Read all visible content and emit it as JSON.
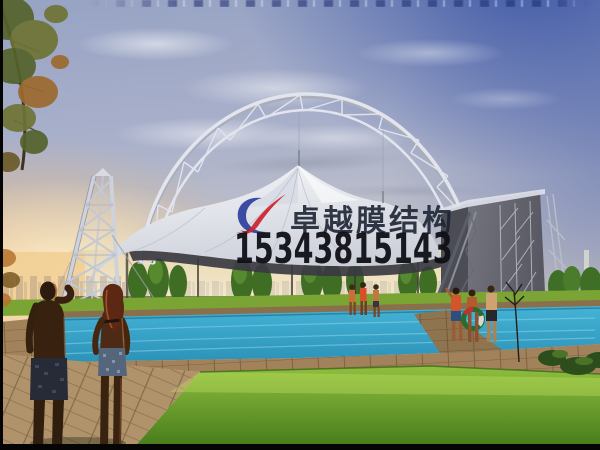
{
  "meta": {
    "description": "Architectural rendering of a white tensile membrane canopy with a steel lattice arch over an outdoor swimming pool at sunset",
    "width_px": 600,
    "height_px": 450
  },
  "watermark": {
    "brand_text": "卓越膜结构",
    "phone_number": "15343815143",
    "logo_colors": {
      "blue": "#2c3f9c",
      "red": "#cf2430"
    }
  },
  "colors": {
    "sky_deep_blue": "#4f66ad",
    "sky_pale": "#aeb6cf",
    "horizon_cream": "#ecdfc0",
    "sunset_orange": "#e8a45f",
    "membrane_white": "#eef0f4",
    "steel_gray": "#c6cad4",
    "underside_dark": "#3a3a42",
    "pylon_wall_gray": "#63636d",
    "pool_blue": "#35a2c6",
    "lawn_green": "#61a426",
    "deck_tan": "#a1825a",
    "tree_green": "#3f6d24",
    "watermark_text": "#1d2433",
    "phone_text": "#0f0f16"
  },
  "scene": {
    "structures": [
      "steel truss arch",
      "twin-peak membrane canopy",
      "lattice pylon tower",
      "gray end pylon wall"
    ],
    "ground": [
      "poplar tree row",
      "swimming pool",
      "tiled deck",
      "lawn"
    ],
    "people": {
      "foreground_couple": 2,
      "mid_poolside": 3,
      "right_poolside": 3
    }
  }
}
